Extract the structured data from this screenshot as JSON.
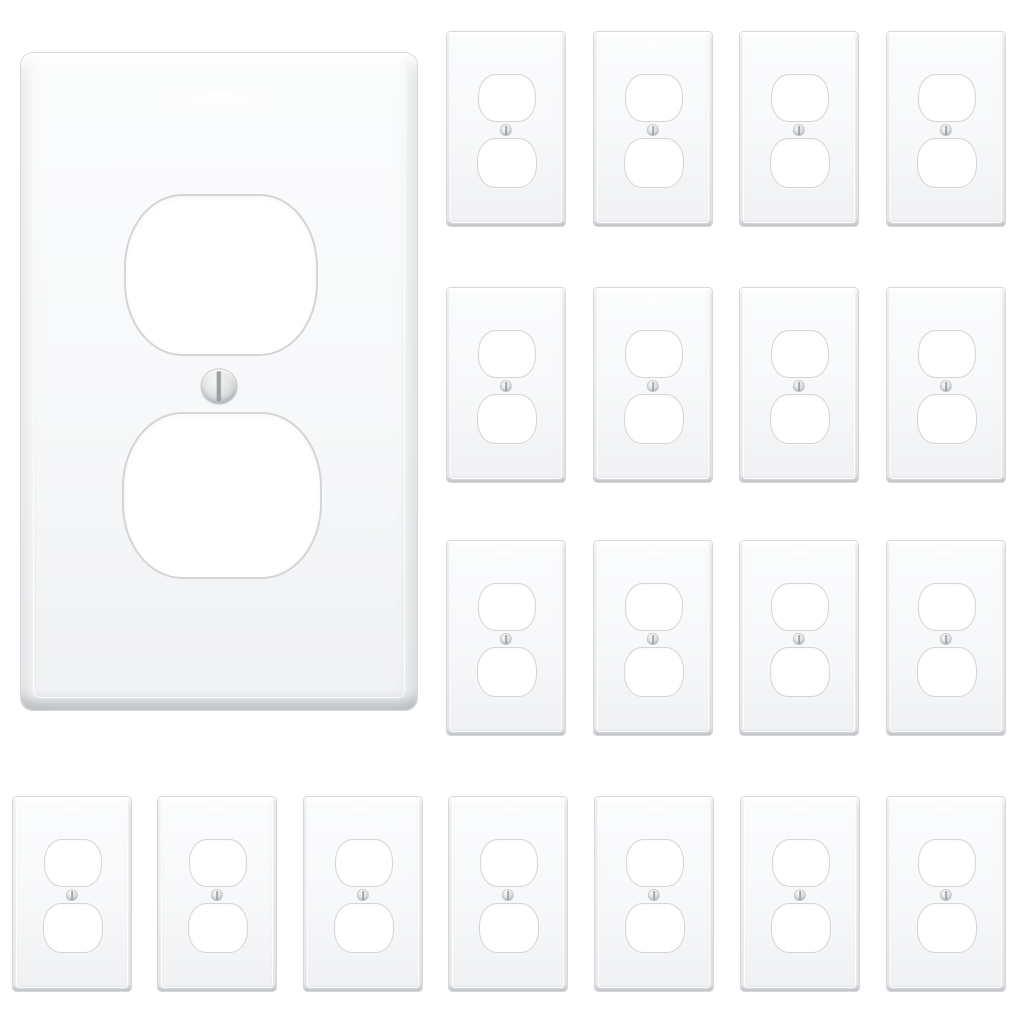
{
  "image": {
    "description": "Product image of white 1-gang duplex receptacle outlet wall plates: one large plate at upper left, a 4x3 grid of small plates at right, and a row of 7 small plates along the bottom",
    "plate_style": "duplex outlet cover with two receptacle cutouts and one center screw",
    "plate_color_name": "white",
    "total_plates": 20,
    "counts": {
      "hero": 1,
      "grid": 12,
      "bottom_row": 7
    }
  },
  "colors": {
    "background": "#ffffff",
    "plate_face": "#fbfcfd",
    "plate_face_shade": "#f0f1f3",
    "plate_outline": "#d5d7d9",
    "bevel_shadow": "#c9cbcd",
    "cutout_fill": "#ffffff",
    "cutout_outline": "#d3d5d7",
    "screw_light": "#f7f8f8",
    "screw_mid": "#dcdedf",
    "screw_dark": "#b6b8ba",
    "screw_slot": "#8f9296"
  },
  "layout": {
    "canvas": {
      "width": 1024,
      "height": 1024
    },
    "groups": [
      {
        "name": "hero",
        "scale": 1,
        "plates": [
          {
            "x": 21,
            "y": 53,
            "w": 396,
            "h": 657
          }
        ]
      },
      {
        "name": "grid",
        "scale": 0.3,
        "plates": [
          {
            "x": 447,
            "y": 32,
            "w": 118,
            "h": 194
          },
          {
            "x": 594,
            "y": 32,
            "w": 118,
            "h": 194
          },
          {
            "x": 740,
            "y": 32,
            "w": 118,
            "h": 194
          },
          {
            "x": 887,
            "y": 32,
            "w": 118,
            "h": 194
          },
          {
            "x": 447,
            "y": 288,
            "w": 118,
            "h": 194
          },
          {
            "x": 594,
            "y": 288,
            "w": 118,
            "h": 194
          },
          {
            "x": 740,
            "y": 288,
            "w": 118,
            "h": 194
          },
          {
            "x": 887,
            "y": 288,
            "w": 118,
            "h": 194
          },
          {
            "x": 447,
            "y": 541,
            "w": 118,
            "h": 194
          },
          {
            "x": 594,
            "y": 541,
            "w": 118,
            "h": 194
          },
          {
            "x": 740,
            "y": 541,
            "w": 118,
            "h": 194
          },
          {
            "x": 887,
            "y": 541,
            "w": 118,
            "h": 194
          }
        ]
      },
      {
        "name": "bottom-row",
        "scale": 0.3,
        "plates": [
          {
            "x": 13,
            "y": 797,
            "w": 118,
            "h": 194
          },
          {
            "x": 158,
            "y": 797,
            "w": 118,
            "h": 194
          },
          {
            "x": 304,
            "y": 797,
            "w": 118,
            "h": 194
          },
          {
            "x": 449,
            "y": 797,
            "w": 118,
            "h": 194
          },
          {
            "x": 595,
            "y": 797,
            "w": 118,
            "h": 194
          },
          {
            "x": 741,
            "y": 797,
            "w": 118,
            "h": 194
          },
          {
            "x": 887,
            "y": 797,
            "w": 118,
            "h": 194
          }
        ]
      }
    ]
  }
}
